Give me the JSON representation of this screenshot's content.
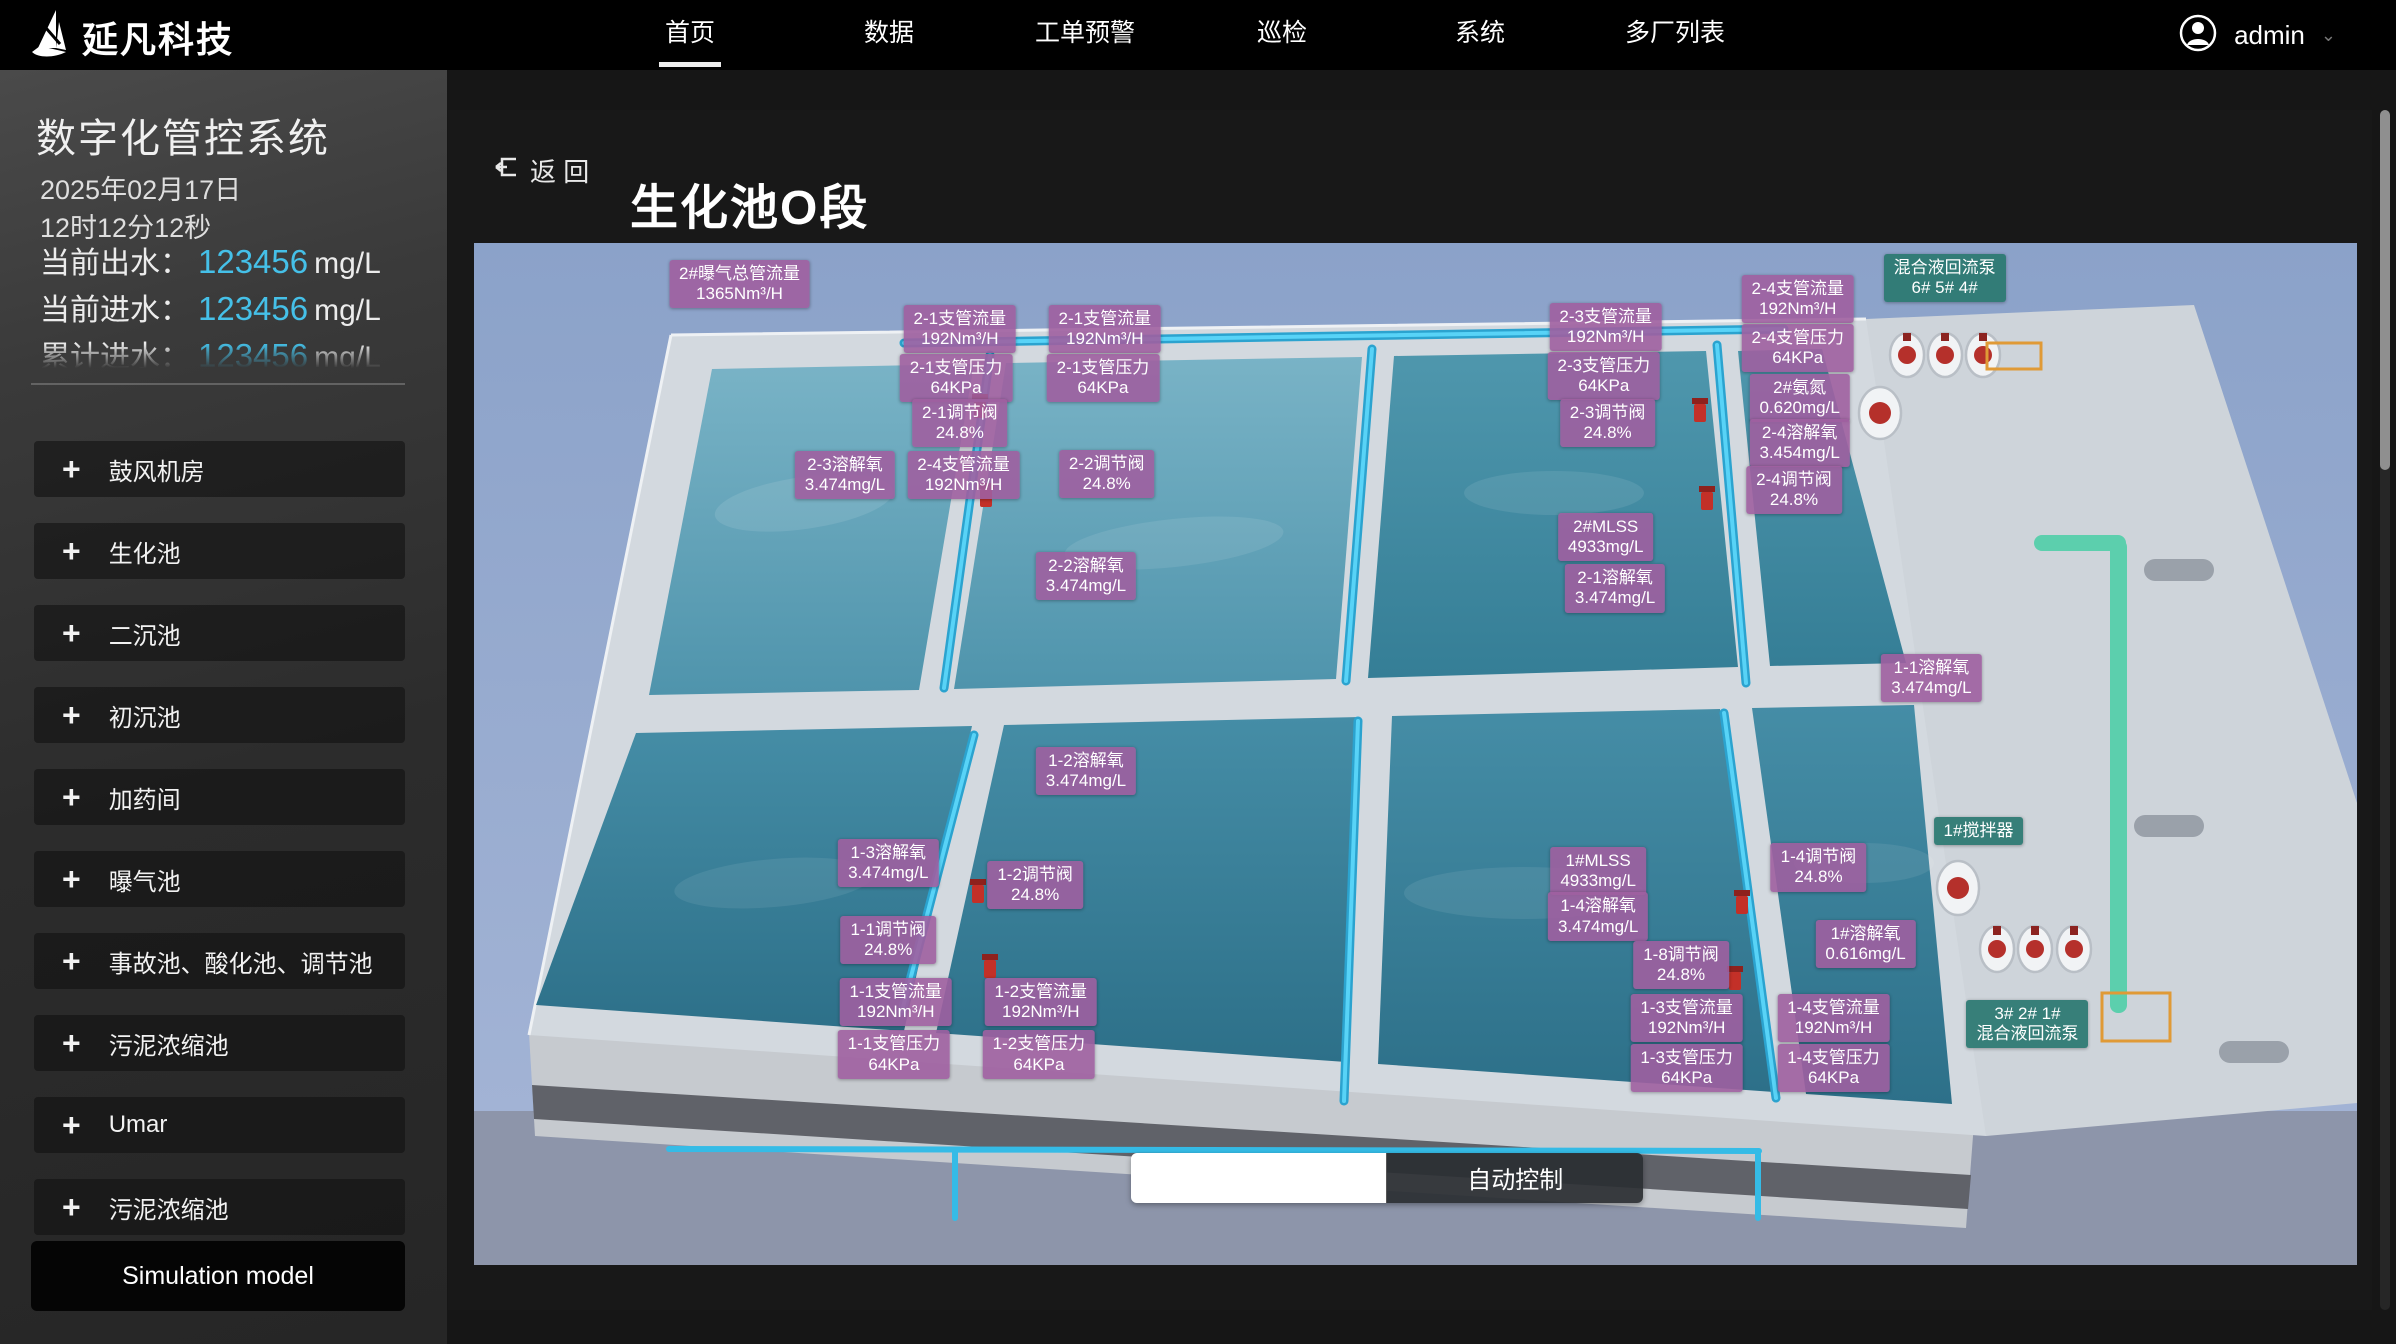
{
  "brand": {
    "name": "延凡科技"
  },
  "nav": {
    "items": [
      {
        "label": "首页",
        "active": true
      },
      {
        "label": "数据",
        "active": false
      },
      {
        "label": "工单预警",
        "active": false
      },
      {
        "label": "巡检",
        "active": false
      },
      {
        "label": "系统",
        "active": false
      },
      {
        "label": "多厂列表",
        "active": false
      }
    ],
    "user": "admin"
  },
  "icons": {
    "plus": "+",
    "caret_down": "⌄"
  },
  "sidebar": {
    "title": "数字化管控系统",
    "date": "2025年02月17日",
    "time": "12时12分12秒",
    "metrics": [
      {
        "label": "当前出水：",
        "value": "123456",
        "unit": "mg/L",
        "clipped": false
      },
      {
        "label": "当前进水：",
        "value": "123456",
        "unit": "mg/L",
        "clipped": false
      },
      {
        "label": "累计进水：",
        "value": "123456",
        "unit": "mg/L",
        "clipped": true
      }
    ],
    "menu": [
      "鼓风机房",
      "生化池",
      "二沉池",
      "初沉池",
      "加药间",
      "曝气池",
      "事故池、酸化池、调节池",
      "污泥浓缩池",
      "Umar",
      "污泥浓缩池"
    ],
    "simulation_button": "Simulation model"
  },
  "main": {
    "back_label": "返 回",
    "title": "生化池O段",
    "controls": {
      "auto_label": "自动控制"
    },
    "labels": [
      {
        "line1": "2#曝气总管流量",
        "line2": "1365Nm³/H",
        "x": 14.1,
        "y": 4.0,
        "type": "sensor"
      },
      {
        "line1": "2-1支管流量",
        "line2": "192Nm³/H",
        "x": 25.8,
        "y": 8.4,
        "type": "sensor"
      },
      {
        "line1": "2-1支管流量",
        "line2": "192Nm³/H",
        "x": 33.5,
        "y": 8.4,
        "type": "sensor"
      },
      {
        "line1": "2-1支管压力",
        "line2": "64KPa",
        "x": 25.6,
        "y": 13.2,
        "type": "sensor"
      },
      {
        "line1": "2-1支管压力",
        "line2": "64KPa",
        "x": 33.4,
        "y": 13.2,
        "type": "sensor"
      },
      {
        "line1": "2-1调节阀",
        "line2": "24.8%",
        "x": 25.8,
        "y": 17.6,
        "type": "sensor"
      },
      {
        "line1": "2-3溶解氧",
        "line2": "3.474mg/L",
        "x": 19.7,
        "y": 22.7,
        "type": "sensor"
      },
      {
        "line1": "2-4支管流量",
        "line2": "192Nm³/H",
        "x": 26.0,
        "y": 22.7,
        "type": "sensor"
      },
      {
        "line1": "2-2调节阀",
        "line2": "24.8%",
        "x": 33.6,
        "y": 22.6,
        "type": "sensor"
      },
      {
        "line1": "2-2溶解氧",
        "line2": "3.474mg/L",
        "x": 32.5,
        "y": 32.6,
        "type": "sensor"
      },
      {
        "line1": "2-3支管流量",
        "line2": "192Nm³/H",
        "x": 60.1,
        "y": 8.2,
        "type": "sensor"
      },
      {
        "line1": "2-3支管压力",
        "line2": "64KPa",
        "x": 60.0,
        "y": 13.0,
        "type": "sensor"
      },
      {
        "line1": "2-3调节阀",
        "line2": "24.8%",
        "x": 60.2,
        "y": 17.6,
        "type": "sensor"
      },
      {
        "line1": "2-4支管流量",
        "line2": "192Nm³/H",
        "x": 70.3,
        "y": 5.5,
        "type": "sensor"
      },
      {
        "line1": "2-4支管压力",
        "line2": "64KPa",
        "x": 70.3,
        "y": 10.3,
        "type": "sensor"
      },
      {
        "line1": "2#氨氮",
        "line2": "0.620mg/L",
        "x": 70.4,
        "y": 15.2,
        "type": "sensor"
      },
      {
        "line1": "2-4溶解氧",
        "line2": "3.454mg/L",
        "x": 70.4,
        "y": 19.6,
        "type": "sensor"
      },
      {
        "line1": "2-4调节阀",
        "line2": "24.8%",
        "x": 70.1,
        "y": 24.2,
        "type": "sensor"
      },
      {
        "line1": "混合液回流泵",
        "line2": "6# 5# 4#",
        "x": 78.1,
        "y": 3.4,
        "type": "device"
      },
      {
        "line1": "2#MLSS",
        "line2": "4933mg/L",
        "x": 60.1,
        "y": 28.8,
        "type": "sensor"
      },
      {
        "line1": "2-1溶解氧",
        "line2": "3.474mg/L",
        "x": 60.6,
        "y": 33.8,
        "type": "sensor"
      },
      {
        "line1": "1-1溶解氧",
        "line2": "3.474mg/L",
        "x": 77.4,
        "y": 42.6,
        "type": "sensor"
      },
      {
        "line1": "1-2溶解氧",
        "line2": "3.474mg/L",
        "x": 32.5,
        "y": 51.7,
        "type": "sensor"
      },
      {
        "line1": "1-3溶解氧",
        "line2": "3.474mg/L",
        "x": 22.0,
        "y": 60.7,
        "type": "sensor"
      },
      {
        "line1": "1-2调节阀",
        "line2": "24.8%",
        "x": 29.8,
        "y": 62.8,
        "type": "sensor"
      },
      {
        "line1": "1-1调节阀",
        "line2": "24.8%",
        "x": 22.0,
        "y": 68.2,
        "type": "sensor"
      },
      {
        "line1": "1-1支管流量",
        "line2": "192Nm³/H",
        "x": 22.4,
        "y": 74.3,
        "type": "sensor"
      },
      {
        "line1": "1-2支管流量",
        "line2": "192Nm³/H",
        "x": 30.1,
        "y": 74.3,
        "type": "sensor"
      },
      {
        "line1": "1-1支管压力",
        "line2": "64KPa",
        "x": 22.3,
        "y": 79.4,
        "type": "sensor"
      },
      {
        "line1": "1-2支管压力",
        "line2": "64KPa",
        "x": 30.0,
        "y": 79.4,
        "type": "sensor"
      },
      {
        "line1": "1#MLSS",
        "line2": "4933mg/L",
        "x": 59.7,
        "y": 61.4,
        "type": "sensor"
      },
      {
        "line1": "1-4调节阀",
        "line2": "24.8%",
        "x": 71.4,
        "y": 61.1,
        "type": "sensor"
      },
      {
        "line1": "1-4溶解氧",
        "line2": "3.474mg/L",
        "x": 59.7,
        "y": 65.9,
        "type": "sensor"
      },
      {
        "line1": "1-8调节阀",
        "line2": "24.8%",
        "x": 64.1,
        "y": 70.6,
        "type": "sensor"
      },
      {
        "line1": "1#溶解氧",
        "line2": "0.616mg/L",
        "x": 73.9,
        "y": 68.6,
        "type": "sensor"
      },
      {
        "line1": "1-3支管流量",
        "line2": "192Nm³/H",
        "x": 64.4,
        "y": 75.8,
        "type": "sensor"
      },
      {
        "line1": "1-4支管流量",
        "line2": "192Nm³/H",
        "x": 72.2,
        "y": 75.8,
        "type": "sensor"
      },
      {
        "line1": "1-3支管压力",
        "line2": "64KPa",
        "x": 64.4,
        "y": 80.7,
        "type": "sensor"
      },
      {
        "line1": "1-4支管压力",
        "line2": "64KPa",
        "x": 72.2,
        "y": 80.7,
        "type": "sensor"
      },
      {
        "line1": "1#搅拌器",
        "line2": "",
        "x": 79.9,
        "y": 57.5,
        "type": "device"
      },
      {
        "line1": "3# 2# 1#",
        "line2": "混合液回流泵",
        "x": 82.5,
        "y": 76.4,
        "type": "device"
      }
    ],
    "arrows": [
      {
        "x": 17.6,
        "y": 7.1,
        "dir": "right"
      },
      {
        "x": 90.2,
        "y": 13.3,
        "dir": "right"
      },
      {
        "x": 92.2,
        "y": 31.8,
        "dir": "left"
      },
      {
        "x": 96.4,
        "y": 47.9,
        "dir": "right"
      },
      {
        "x": 95.1,
        "y": 56.8,
        "dir": "left"
      },
      {
        "x": 97.9,
        "y": 78.8,
        "dir": "right"
      },
      {
        "x": 8.9,
        "y": 89.1,
        "dir": "right"
      }
    ]
  },
  "colors": {
    "accent_blue": "#45c0e8",
    "label_purple": "#9f5fa0",
    "label_teal": "#2b7971",
    "nav_bg": "#000000",
    "water_teal": "#3f8ca4",
    "pipe_cyan": "#4ac8ef",
    "pipe_green": "#5ccfad"
  }
}
